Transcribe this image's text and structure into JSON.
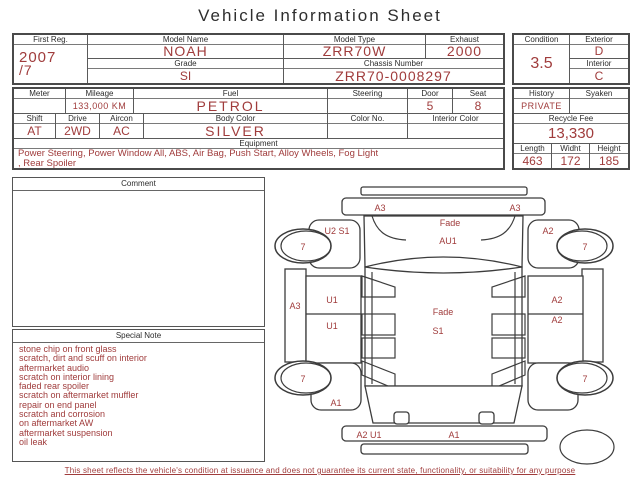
{
  "title": "Vehicle Information Sheet",
  "accent_color": "#a03c3c",
  "vehicle": {
    "first_reg": {
      "label": "First Reg.",
      "lines": [
        "2007",
        "/7"
      ]
    },
    "model_name": {
      "label": "Model Name",
      "value": "NOAH"
    },
    "model_type": {
      "label": "Model Type",
      "value": "ZRR70W"
    },
    "exhaust": {
      "label": "Exhaust",
      "value": "2000"
    },
    "grade": {
      "label": "Grade",
      "value": "SI"
    },
    "chassis_number": {
      "label": "Chassis Number",
      "value": "ZRR70-0008297"
    },
    "condition": {
      "label": "Condition",
      "value": "3.5"
    },
    "exterior": {
      "label": "Exterior",
      "value": "D"
    },
    "interior": {
      "label": "Interior",
      "value": "C"
    }
  },
  "details": {
    "meter": {
      "label": "Meter",
      "value": ""
    },
    "mileage": {
      "label": "Mileage",
      "value": "133,000 KM"
    },
    "fuel": {
      "label": "Fuel",
      "value": "PETROL"
    },
    "steering": {
      "label": "Steering",
      "value": ""
    },
    "door": {
      "label": "Door",
      "value": "5"
    },
    "seat": {
      "label": "Seat",
      "value": "8"
    },
    "shift": {
      "label": "Shift",
      "value": "AT"
    },
    "drive": {
      "label": "Drive",
      "value": "2WD"
    },
    "aircon": {
      "label": "Aircon",
      "value": "AC"
    },
    "body_color": {
      "label": "Body Color",
      "value": "SILVER"
    },
    "color_no": {
      "label": "Color No.",
      "value": ""
    },
    "interior_color": {
      "label": "Interior Color",
      "value": ""
    },
    "equipment": {
      "label": "Equipment",
      "lines": [
        "Power Steering, Power Window  All, ABS, Air Bag, Push Start, Alloy Wheels, Fog Light",
        ", Rear Spoiler"
      ]
    }
  },
  "right_panel": {
    "history": {
      "label": "History",
      "value": "PRIVATE"
    },
    "syaken": {
      "label": "Syaken",
      "value": ""
    },
    "recycle_fee": {
      "label": "Recycle Fee",
      "value": "13,330"
    },
    "length": {
      "label": "Length",
      "value": "463"
    },
    "width": {
      "label": "Widht",
      "value": "172"
    },
    "height": {
      "label": "Height",
      "value": "185"
    }
  },
  "comment": {
    "label": "Comment",
    "body": ""
  },
  "special_note": {
    "label": "Special Note",
    "lines": [
      "stone chip on front glass",
      "scratch, dirt and scuff on interior",
      "aftermarket audio",
      "scratch on interior lining",
      "faded rear spoiler",
      "scratch on aftermarket muffler",
      "repair on end panel",
      "scratch and corrosion",
      "on aftermarket AW",
      "aftermarket suspension",
      "oil leak"
    ]
  },
  "diagram": {
    "labels": {
      "front_bar_left": "A3",
      "front_bar_right": "A3",
      "fade_front": "Fade",
      "au1": "AU1",
      "left_front_fender": "U2 S1",
      "right_front_fender": "A2",
      "left_sill": "A3",
      "left_door_front": "U1",
      "left_door_rear": "U1",
      "right_door_front": "A2",
      "right_door_rear": "A2",
      "roof_fade": "Fade",
      "roof_s1": "S1",
      "left_rear_fender": "A1",
      "rear_bar_left": "A2 U1",
      "rear_bar_center": "A1",
      "wheel_front_left": "7",
      "wheel_front_right": "7",
      "wheel_rear_left": "7",
      "wheel_rear_right": "7"
    }
  },
  "footer": "This sheet reflects the vehicle's condition at issuance and does not guarantee its current state, functionality, or suitability for any purpose"
}
